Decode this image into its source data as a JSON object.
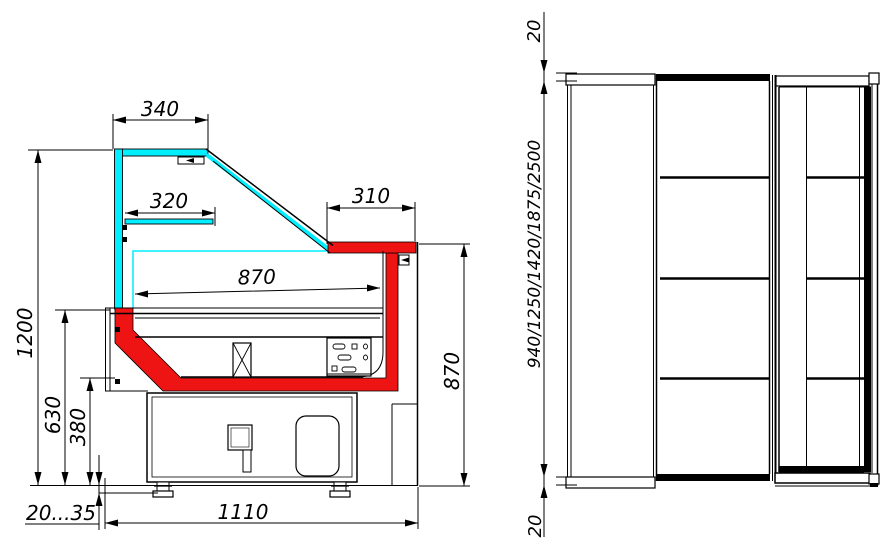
{
  "drawing": {
    "title": "Refrigerated display showcase — dimensioned technical drawing",
    "views": {
      "side_section": "side section view",
      "front": "front view"
    }
  },
  "colors": {
    "background": "#ffffff",
    "line": "#000000",
    "glass": "#00eeff",
    "accent": "#ee1414"
  },
  "dims": {
    "canopy_width": "340",
    "shelf_width": "320",
    "counter_depth": "310",
    "interior_depth": "870",
    "overall_height": "1200",
    "deck_height": "630",
    "base_height": "380",
    "foot_adjust": "20...35",
    "overall_depth": "1110",
    "counter_height": "870",
    "top_clearance": "20",
    "height_options": "940/1250/1420/1875/2500",
    "bottom_clearance": "20"
  }
}
